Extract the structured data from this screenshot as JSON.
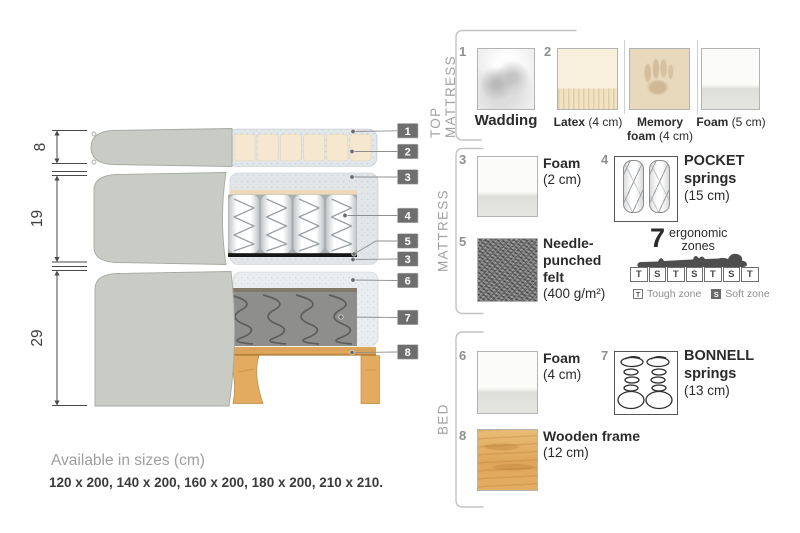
{
  "diagram": {
    "dims": [
      {
        "value": "8"
      },
      {
        "value": "19"
      },
      {
        "value": "29"
      }
    ],
    "callouts": [
      {
        "num": "1"
      },
      {
        "num": "2"
      },
      {
        "num": "3"
      },
      {
        "num": "4"
      },
      {
        "num": "5"
      },
      {
        "num": "3"
      },
      {
        "num": "6"
      },
      {
        "num": "7"
      },
      {
        "num": "8"
      }
    ]
  },
  "panel": {
    "sections": [
      {
        "title": "TOP MATTRESS"
      },
      {
        "title": "MATTRESS"
      },
      {
        "title": "BED"
      }
    ],
    "items": {
      "wadding": {
        "num": "1",
        "name": "Wadding"
      },
      "latex": {
        "num": "2",
        "name": "Latex",
        "size": "(4 cm)"
      },
      "memory": {
        "name": "Memory foam",
        "size": "(4 cm)"
      },
      "foam5": {
        "name": "Foam",
        "size": "(5 cm)"
      },
      "foam2": {
        "num": "3",
        "name": "Foam",
        "size": "(2 cm)"
      },
      "pocket": {
        "num": "4",
        "name": "POCKET springs",
        "size": "(15 cm)"
      },
      "felt": {
        "num": "5",
        "name": "Needle-punched felt",
        "size": "(400 g/m²)"
      },
      "foam4": {
        "num": "6",
        "name": "Foam",
        "size": "(4 cm)"
      },
      "bonnell": {
        "num": "7",
        "name": "BONNELL springs",
        "size": "(13 cm)"
      },
      "wood": {
        "num": "8",
        "name": "Wooden frame",
        "size": "(12 cm)"
      }
    },
    "ergonomic": {
      "number": "7",
      "caption_line1": "ergonomic",
      "caption_line2": "zones",
      "zones": [
        "T",
        "S",
        "T",
        "S",
        "T",
        "S",
        "T"
      ],
      "legend": [
        {
          "key": "T",
          "label": "Tough zone"
        },
        {
          "key": "S",
          "label": "Soft zone"
        }
      ]
    }
  },
  "footer": {
    "title": "Available in sizes (cm)",
    "sizes": "120 x 200, 140 x 200, 160 x 200, 180 x 200, 210 x 210."
  },
  "colors": {
    "cover_fabric": "#c9ccc4",
    "latex_cream": "#f6e8d0",
    "wood": "#dfa55b",
    "callout_box": "#6e6e6e",
    "felt_black": "#161616",
    "bonnell_gray": "#8e8e8d"
  }
}
